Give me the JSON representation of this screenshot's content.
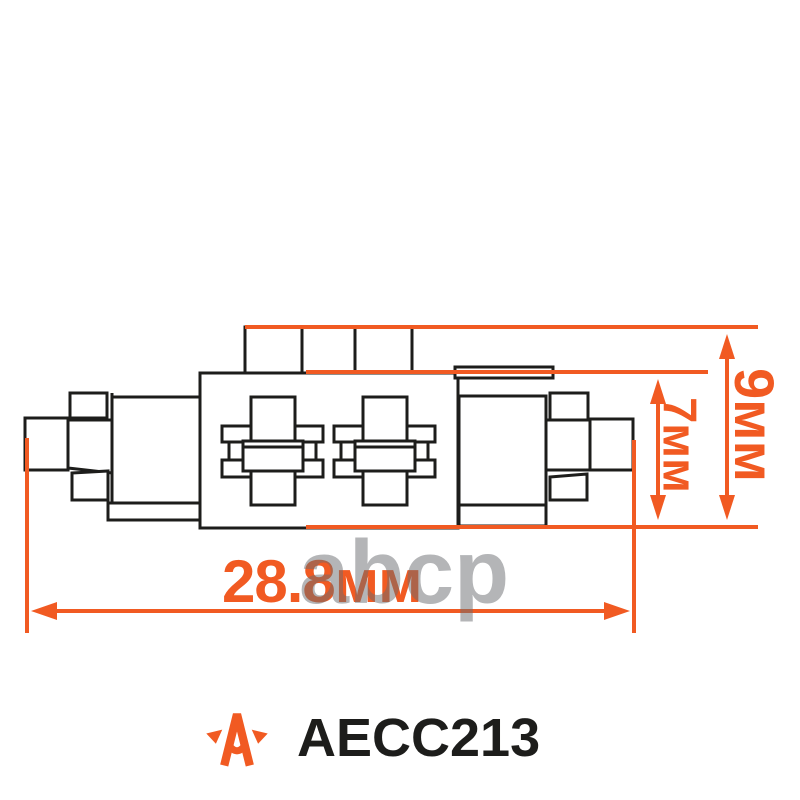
{
  "product_image": {
    "part_number": "AECC213",
    "watermark_text": "abcp",
    "dimensions": {
      "width_label": "28.8мм",
      "body_height_label": "7мм",
      "overall_height_label": "9мм"
    },
    "icons": {
      "brand_logo": "star-a-icon"
    },
    "colors": {
      "accent_orange": "#f15a22",
      "line_black": "#1d1d1b",
      "watermark_gray": "#b4b6ba"
    }
  }
}
